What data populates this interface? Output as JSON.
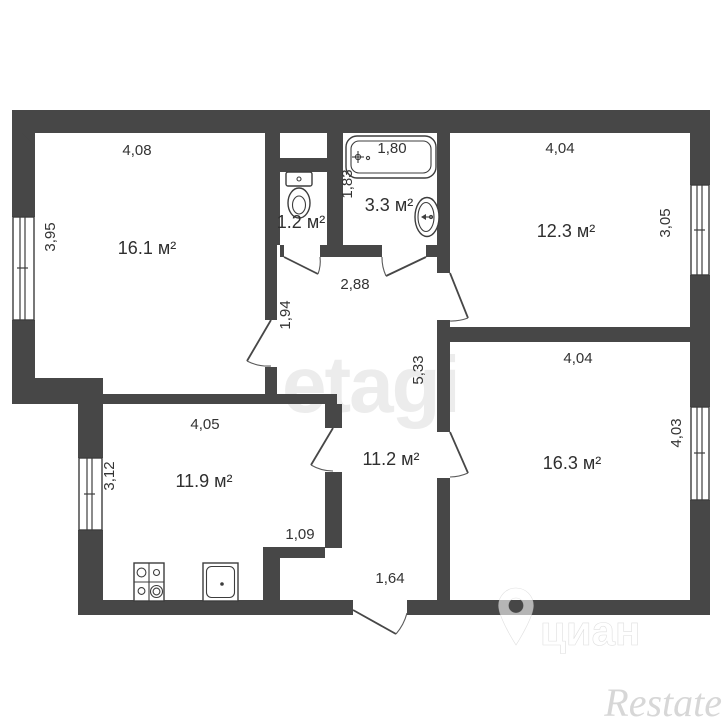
{
  "plan": {
    "living": {
      "area": "16.1 м²",
      "dim_top": "4,08",
      "dim_left": "3,95"
    },
    "wc": {
      "area": "1.2 м²"
    },
    "bathroom": {
      "area": "3.3 м²",
      "dim_tub": "1,80",
      "dim_left": "1,83"
    },
    "bedroom_top": {
      "area": "12.3 м²",
      "dim_top": "4,04",
      "dim_right": "3,05"
    },
    "bedroom_bottom": {
      "area": "16.3 м²",
      "dim_top": "4,04",
      "dim_right": "4,03"
    },
    "kitchen": {
      "area": "11.9 м²",
      "dim_top": "4,05",
      "dim_left": "3,12",
      "dim_nook": "1,09"
    },
    "hall": {
      "area": "11.2 м²",
      "dim_top": "2,88",
      "dim_left": "1,94",
      "dim_right": "5,33",
      "dim_entry": "1,64"
    }
  },
  "watermarks": {
    "etagi": "etagi",
    "cian": "циан",
    "restate": "Restate"
  },
  "colors": {
    "wall": "#474747",
    "text": "#333333",
    "watermark_light": "#ececec",
    "watermark_restate": "#d7d7d7"
  }
}
